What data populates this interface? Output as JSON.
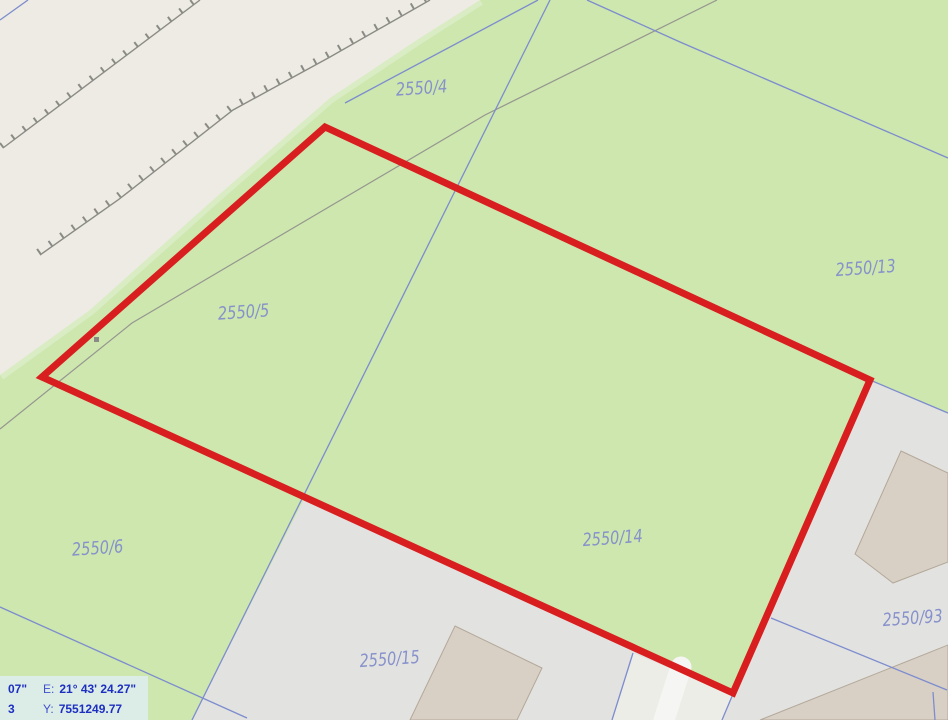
{
  "map": {
    "colors": {
      "background": "#cde7ae",
      "road": "#edebe3",
      "road_edge_highlight": "#d9ecc3",
      "urban": "#e2e2e0",
      "path_strip": "#ecede6",
      "walkway": "#f5f5f3",
      "building_fill": "#d8d0c5",
      "building_border": "#b3a899",
      "boundary_blue": "#7d8cce",
      "gray_line": "#96968f",
      "hatch": "#8b8b85",
      "selection_red": "#d81e1e",
      "label_blue": "#8791cb",
      "status_bg": "#dcede8",
      "status_value": "#1d2fc0",
      "status_label": "#4050cc"
    },
    "shapes": [
      {
        "kind": "polyline",
        "name": "road-edge-highlight",
        "interactable": false,
        "points": [
          [
            480,
            0
          ],
          [
            420,
            38
          ],
          [
            330,
            98
          ],
          [
            213,
            200
          ],
          [
            90,
            310
          ],
          [
            0,
            375
          ]
        ],
        "stroke": "#d9ecc3",
        "width": 11
      },
      {
        "kind": "polygon",
        "name": "road-area",
        "interactable": false,
        "points": [
          [
            0,
            0
          ],
          [
            480,
            0
          ],
          [
            420,
            38
          ],
          [
            330,
            98
          ],
          [
            213,
            200
          ],
          [
            90,
            310
          ],
          [
            0,
            375
          ]
        ],
        "fill": "#edebe3"
      },
      {
        "kind": "polygon",
        "name": "urban-area",
        "interactable": false,
        "points": [
          [
            305,
            497
          ],
          [
            733,
            693
          ],
          [
            870,
            380
          ],
          [
            948,
            413
          ],
          [
            948,
            720
          ],
          [
            192,
            720
          ]
        ],
        "fill": "#e2e2e0"
      },
      {
        "kind": "polygon",
        "name": "path-parcel-strip",
        "interactable": false,
        "points": [
          [
            633,
            653
          ],
          [
            733,
            694
          ],
          [
            722,
            720
          ],
          [
            612,
            720
          ]
        ],
        "fill": "#ecede6"
      },
      {
        "kind": "polyline",
        "name": "walkway",
        "interactable": false,
        "points": [
          [
            681,
            667
          ],
          [
            664,
            720
          ]
        ],
        "stroke": "#f5f5f3",
        "width": 21,
        "cap": "round"
      },
      {
        "kind": "polygon",
        "name": "building",
        "interactable": false,
        "points": [
          [
            455,
            626
          ],
          [
            542,
            668
          ],
          [
            517,
            720
          ],
          [
            410,
            720
          ]
        ],
        "fill": "#d8d0c5",
        "stroke": "#b3a899",
        "width": 1
      },
      {
        "kind": "polygon",
        "name": "building",
        "interactable": false,
        "points": [
          [
            901,
            451
          ],
          [
            948,
            473
          ],
          [
            948,
            562
          ],
          [
            893,
            583
          ],
          [
            855,
            554
          ]
        ],
        "fill": "#d8d0c5",
        "stroke": "#b3a899",
        "width": 1
      },
      {
        "kind": "polygon",
        "name": "building",
        "interactable": false,
        "points": [
          [
            760,
            720
          ],
          [
            948,
            645
          ],
          [
            948,
            720
          ]
        ],
        "fill": "#d8d0c5",
        "stroke": "#b3a899",
        "width": 1
      },
      {
        "kind": "polyline",
        "name": "embankment-hatch-ticks",
        "interactable": false,
        "points": [
          [
            1,
            146
          ],
          [
            198,
            -2
          ]
        ],
        "stroke": "#8b8b85",
        "width": 6,
        "dash": "2 12"
      },
      {
        "kind": "polyline",
        "name": "embankment-line",
        "interactable": false,
        "points": [
          [
            3,
            148
          ],
          [
            200,
            0
          ]
        ],
        "stroke": "#8b8b85",
        "width": 1.4
      },
      {
        "kind": "polyline",
        "name": "embankment-hatch-ticks",
        "interactable": false,
        "points": [
          [
            38,
            252
          ],
          [
            116,
            197
          ],
          [
            231,
            107
          ],
          [
            328,
            54
          ],
          [
            428,
            -3
          ]
        ],
        "stroke": "#8b8b85",
        "width": 6,
        "dash": "2 12"
      },
      {
        "kind": "polyline",
        "name": "embankment-line",
        "interactable": false,
        "points": [
          [
            40,
            255
          ],
          [
            118,
            200
          ],
          [
            233,
            110
          ],
          [
            330,
            57
          ],
          [
            430,
            0
          ]
        ],
        "stroke": "#8b8b85",
        "width": 1.4
      },
      {
        "kind": "polyline",
        "name": "track-line",
        "interactable": false,
        "points": [
          [
            717,
            0
          ],
          [
            485,
            115
          ],
          [
            132,
            323
          ],
          [
            0,
            429
          ]
        ],
        "stroke": "#96968f",
        "width": 1.2
      },
      {
        "kind": "rect",
        "name": "survey-point-marker",
        "interactable": false,
        "x": 94,
        "y": 337,
        "w": 5,
        "h": 5,
        "fill": "#8b8b85"
      },
      {
        "kind": "polyline",
        "name": "parcel-boundary",
        "interactable": false,
        "points": [
          [
            0,
            20
          ],
          [
            28,
            0
          ]
        ],
        "stroke": "#7d8cce",
        "width": 1.3
      },
      {
        "kind": "polyline",
        "name": "parcel-boundary",
        "interactable": false,
        "points": [
          [
            538,
            0
          ],
          [
            345,
            103
          ]
        ],
        "stroke": "#7d8cce",
        "width": 1.3
      },
      {
        "kind": "polyline",
        "name": "parcel-boundary",
        "interactable": false,
        "points": [
          [
            587,
            0
          ],
          [
            680,
            42
          ],
          [
            948,
            158
          ]
        ],
        "stroke": "#7d8cce",
        "width": 1.3
      },
      {
        "kind": "polyline",
        "name": "parcel-boundary",
        "interactable": false,
        "points": [
          [
            550,
            0
          ],
          [
            192,
            720
          ]
        ],
        "stroke": "#7d8cce",
        "width": 1.3
      },
      {
        "kind": "polyline",
        "name": "parcel-boundary",
        "interactable": false,
        "points": [
          [
            0,
            607
          ],
          [
            247,
            718
          ]
        ],
        "stroke": "#7d8cce",
        "width": 1.3
      },
      {
        "kind": "polyline",
        "name": "parcel-boundary",
        "interactable": false,
        "points": [
          [
            771,
            618
          ],
          [
            947,
            690
          ]
        ],
        "stroke": "#7d8cce",
        "width": 1.3
      },
      {
        "kind": "polyline",
        "name": "parcel-boundary",
        "interactable": false,
        "points": [
          [
            933,
            692
          ],
          [
            935,
            720
          ]
        ],
        "stroke": "#7d8cce",
        "width": 1.3
      },
      {
        "kind": "polyline",
        "name": "parcel-boundary",
        "interactable": false,
        "points": [
          [
            870,
            380
          ],
          [
            948,
            413
          ]
        ],
        "stroke": "#7d8cce",
        "width": 1.3
      },
      {
        "kind": "polyline",
        "name": "parcel-boundary",
        "interactable": false,
        "points": [
          [
            633,
            653
          ],
          [
            612,
            720
          ]
        ],
        "stroke": "#7d8cce",
        "width": 1.3
      },
      {
        "kind": "polyline",
        "name": "parcel-boundary",
        "interactable": false,
        "points": [
          [
            733,
            694
          ],
          [
            722,
            720
          ]
        ],
        "stroke": "#7d8cce",
        "width": 1.3
      },
      {
        "kind": "polygon",
        "name": "selected-parcel-outline",
        "interactable": true,
        "points": [
          [
            42,
            377
          ],
          [
            325,
            127
          ],
          [
            870,
            380
          ],
          [
            733,
            693
          ]
        ],
        "fill": "none",
        "stroke": "#d81e1e",
        "width": 7
      }
    ],
    "parcel_labels": [
      {
        "text": "2550/4",
        "x": 422,
        "y": 94
      },
      {
        "text": "2550/5",
        "x": 244,
        "y": 318
      },
      {
        "text": "2550/13",
        "x": 866,
        "y": 274
      },
      {
        "text": "2550/6",
        "x": 98,
        "y": 554
      },
      {
        "text": "2550/14",
        "x": 613,
        "y": 544
      },
      {
        "text": "2550/15",
        "x": 390,
        "y": 665
      },
      {
        "text": "2550/93",
        "x": 913,
        "y": 624
      }
    ]
  },
  "statusbar": {
    "row1_fragment": "07\"",
    "row1_label": "E:",
    "row1_value": "21° 43' 24.27\"",
    "row2_fragment": "3",
    "row2_label": "Y:",
    "row2_value": "7551249.77"
  }
}
